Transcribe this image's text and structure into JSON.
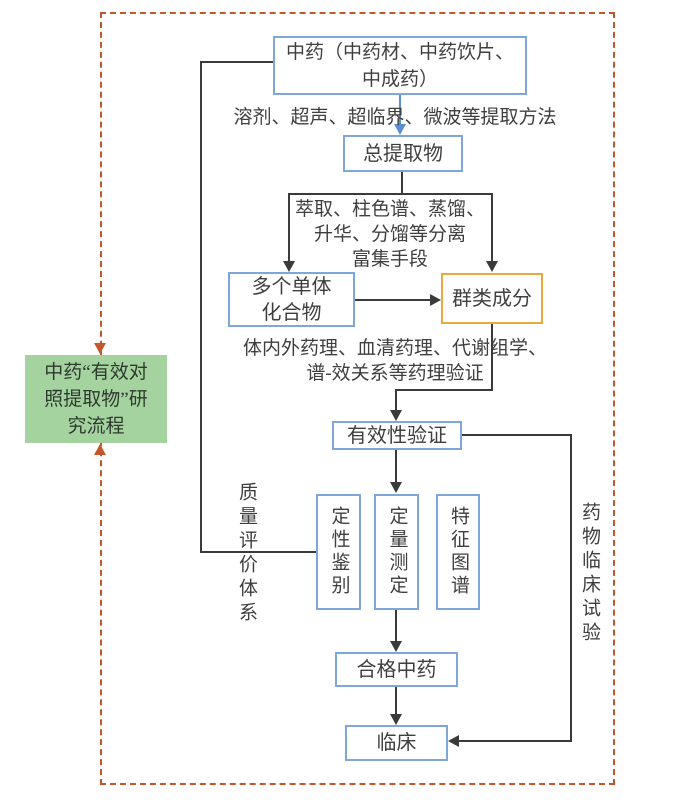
{
  "colors": {
    "box_border_blue": "#7ea6d8",
    "box_border_orange": "#eaa93c",
    "green_fill": "#a5d3a0",
    "dashed_border": "#c2572c",
    "line": "#3a3a3a",
    "text": "#3f3f3f",
    "blue_arrow": "#5b8fce",
    "background": "#ffffff"
  },
  "legend_box": {
    "line1": "中药“有效对",
    "line2": "照提取物”研",
    "line3": "究流程"
  },
  "nodes": {
    "herb_source": {
      "line1": "中药（中药材、中药饮片、",
      "line2": "中成药）"
    },
    "total_extract": {
      "label": "总提取物"
    },
    "monomers": {
      "line1": "多个单体",
      "line2": "化合物"
    },
    "component_groups": {
      "label": "群类成分"
    },
    "efficacy_validation": {
      "label": "有效性验证"
    },
    "qualitative_identification": {
      "label": "定性鉴别"
    },
    "quantitative_determination": {
      "label": "定量测定"
    },
    "characteristic_chromatogram": {
      "label": "特征图谱"
    },
    "qualified_medicine": {
      "label": "合格中药"
    },
    "clinical": {
      "label": "临床"
    }
  },
  "annotations": {
    "extraction_methods": "溶剂、超声、超临界、微波等提取方法",
    "separation_line1": "萃取、柱色谱、蒸馏、",
    "separation_line2": "升华、分馏等分离",
    "separation_line3": "富集手段",
    "pharmacology_line1": "体内外药理、血清药理、代谢组学、",
    "pharmacology_line2": "谱-效关系等药理验证",
    "quality_system": "质量评价体系",
    "clinical_trial": "药物临床试验"
  }
}
